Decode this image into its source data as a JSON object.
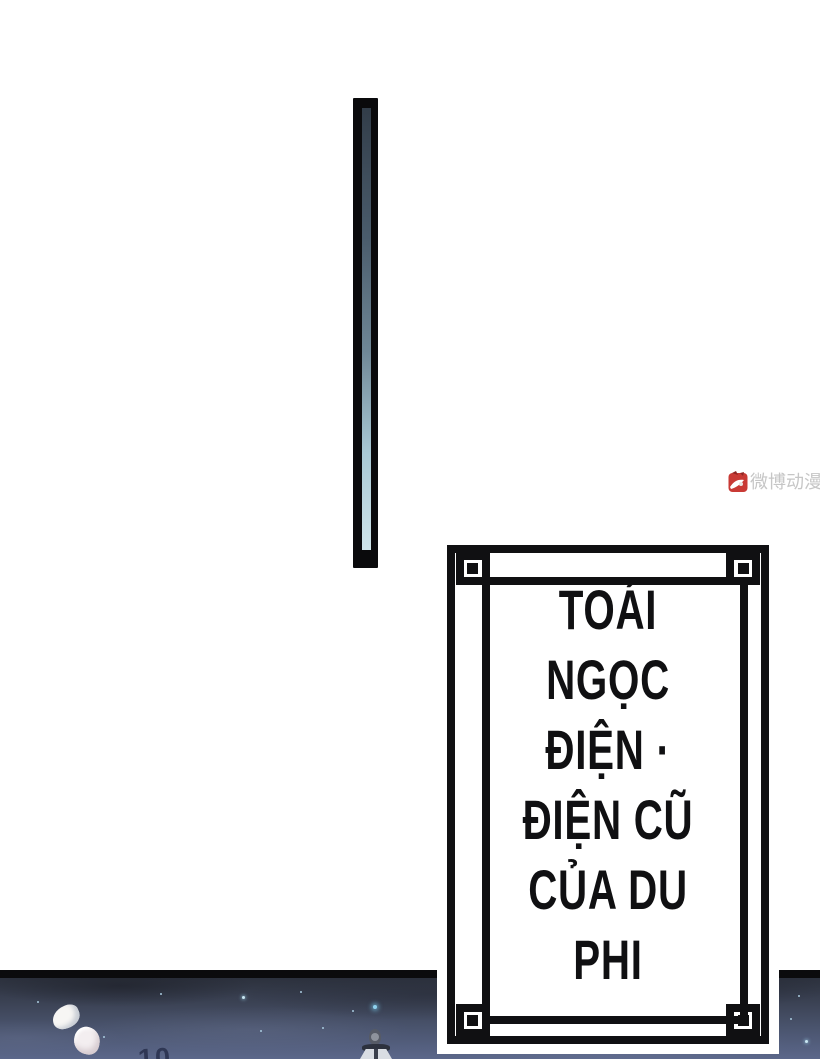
{
  "page": {
    "kind": "comic-page",
    "background_color": "#ffffff",
    "width_px": 820,
    "height_px": 1059
  },
  "watermark": {
    "text": "微博动漫",
    "icon": "weibo-dongman-logo-icon",
    "text_color": "#c6c6c6",
    "icon_color": "#c93a35"
  },
  "title_box": {
    "style": "double-black-frame-with-corner-squares",
    "border_color": "#101012",
    "background": "#ffffff",
    "text_color": "#101012",
    "lines": [
      "TOÁI",
      "NGỌC",
      "ĐIỆN ·",
      "ĐIỆN CŨ",
      "CỦA DU",
      "PHI"
    ],
    "full_text": "TOÁI NGỌC ĐIỆN · ĐIỆN CŨ CỦA DU PHI"
  },
  "scroll_rod": {
    "name": "hanging-scroll-rod",
    "outer_color": "#0a0a0c",
    "inner_gradient_top": "#323d49",
    "inner_gradient_bottom": "#cfe4ea"
  },
  "night_panel": {
    "description": "night-sky-scene-with-stars-petals-and-small-figure",
    "border_color": "#0b0b0d",
    "sky_top_color": "#2c313d",
    "sky_bottom_color": "#5b678a",
    "star_color": "#8fd2ee",
    "petal_color": "#f7f6f4",
    "ground_mark_text": "10"
  }
}
